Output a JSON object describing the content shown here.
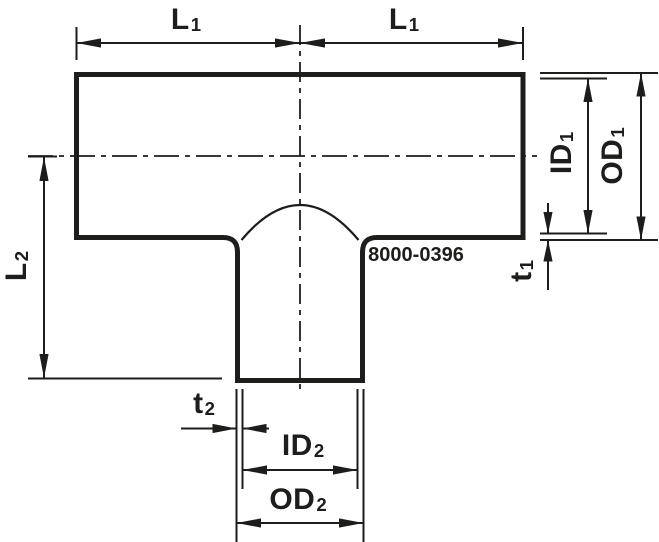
{
  "drawing": {
    "figure_type": "tee-reducer-cross-section",
    "part_number": "8000-0396",
    "line_color": "#1d1d1b",
    "background_color": "#ffffff",
    "labels": {
      "l1_left": {
        "base": "L",
        "sub": "1"
      },
      "l1_right": {
        "base": "L",
        "sub": "1"
      },
      "id1": {
        "base": "ID",
        "sub": "1"
      },
      "od1": {
        "base": "OD",
        "sub": "1"
      },
      "t1": {
        "base": "t",
        "sub": "1"
      },
      "l2": {
        "base": "L",
        "sub": "2"
      },
      "t2": {
        "base": "t",
        "sub": "2"
      },
      "id2": {
        "base": "ID",
        "sub": "2"
      },
      "od2": {
        "base": "OD",
        "sub": "2"
      }
    }
  }
}
